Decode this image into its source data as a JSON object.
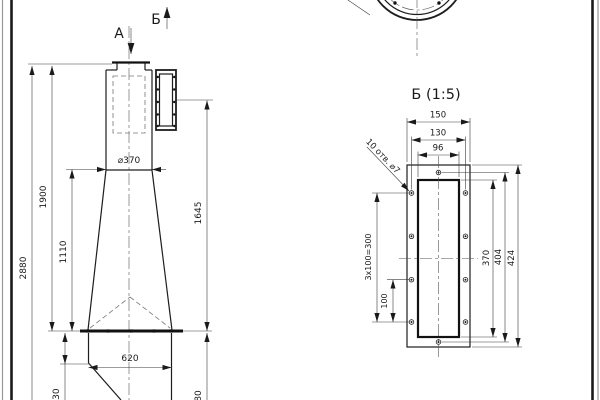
{
  "front": {
    "section_a": "А",
    "section_b": "Б",
    "dim_total_height": "2880",
    "dim_upper_height": "1900",
    "dim_cone_height": "1110",
    "dim_diameter": "⌀370",
    "dim_side_flange": "1645",
    "dim_outlet_width": "620",
    "dim_skirt": "230",
    "dim_bottom": "80"
  },
  "detail": {
    "title": "Б (1:5)",
    "holes_note": "10 отв. ⌀7",
    "dim_width_outer": "150",
    "dim_width_holes": "130",
    "dim_width_inner": "96",
    "dim_height_inner": "370",
    "dim_height_holes": "404",
    "dim_height_outer": "424",
    "dim_hole_pitch": "100",
    "dim_hole_pitch_total": "3x100=300"
  }
}
